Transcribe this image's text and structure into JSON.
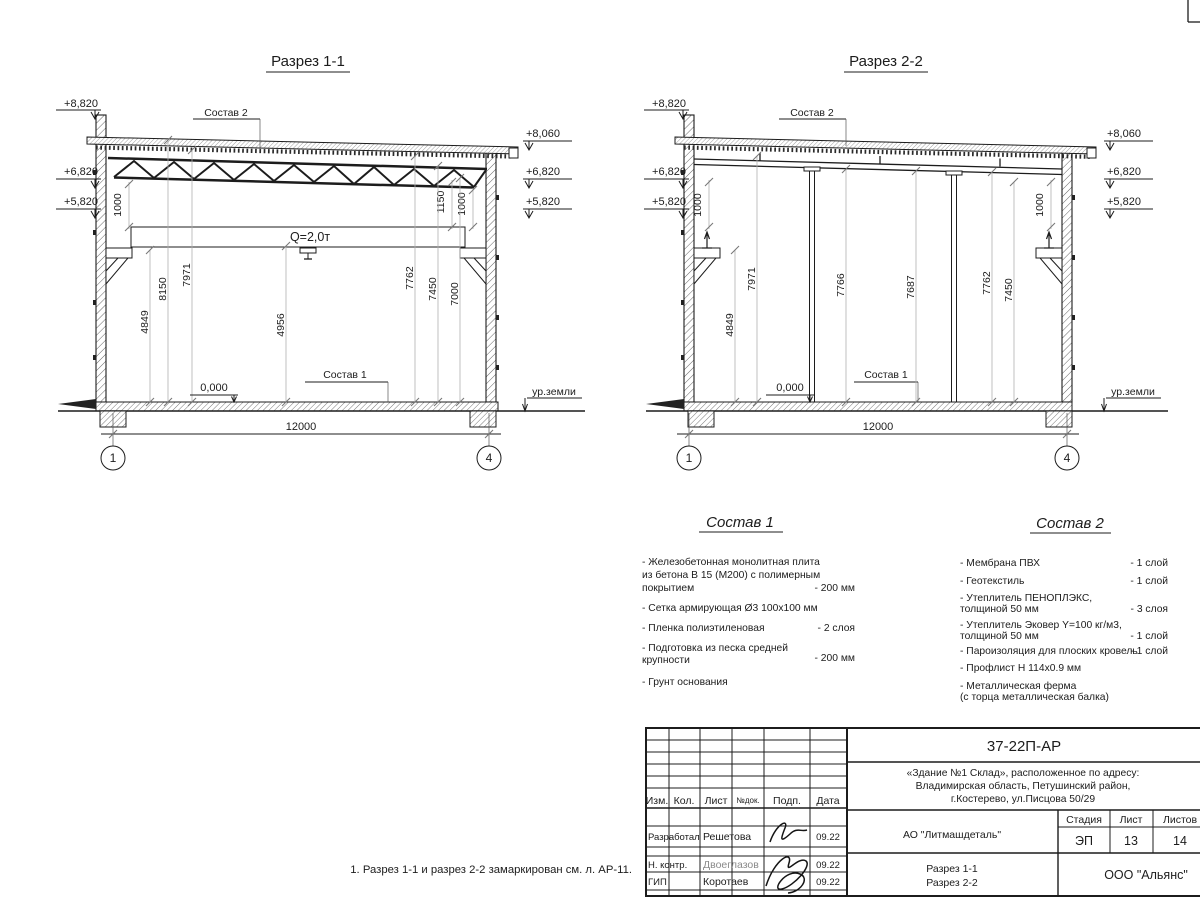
{
  "s1": {
    "title": "Разрез 1-1",
    "sostav2_label": "Состав 2",
    "sostav1_label": "Состав 1",
    "crane_label": "Q=2,0т",
    "elev_left": [
      "+8,820",
      "+6,820",
      "+5,820"
    ],
    "elev_right": [
      "+8,060",
      "+6,820",
      "+5,820"
    ],
    "dim_gap_left": "1000",
    "dim_gap_r1": "1150",
    "dim_gap_r2": "1000",
    "vdims": [
      "4849",
      "8150",
      "7971",
      "4956",
      "7762",
      "7450",
      "7000"
    ],
    "zero_level": "0,000",
    "ground_label": "ур.земли",
    "span": "12000",
    "axis_left": "1",
    "axis_right": "4"
  },
  "s2": {
    "title": "Разрез 2-2",
    "sostav2_label": "Состав 2",
    "sostav1_label": "Состав 1",
    "elev_left": [
      "+8,820",
      "+6,820",
      "+5,820"
    ],
    "elev_right": [
      "+8,060",
      "+6,820",
      "+5,820"
    ],
    "dim_gap_left": "1000",
    "dim_gap_right": "1000",
    "vdims": [
      "4849",
      "7971",
      "7766",
      "7687",
      "7762",
      "7450"
    ],
    "zero_level": "0,000",
    "ground_label": "ур.земли",
    "span": "12000",
    "axis_left": "1",
    "axis_right": "4"
  },
  "sostav1": {
    "title": "Состав 1",
    "items": [
      {
        "lines": [
          "- Железобетонная  монолитная плита",
          "из бетона В 15 (М200) с полимерным",
          "покрытием"
        ],
        "qty": "- 200 мм"
      },
      {
        "lines": [
          "- Сетка армирующая Ø3 100х100 мм"
        ],
        "qty": ""
      },
      {
        "lines": [
          "- Пленка полиэтиленовая"
        ],
        "qty": "-  2 слоя"
      },
      {
        "lines": [
          "- Подготовка из песка средней",
          "  крупности"
        ],
        "qty": "- 200 мм"
      },
      {
        "lines": [
          "- Грунт основания"
        ],
        "qty": ""
      }
    ]
  },
  "sostav2": {
    "title": "Состав 2",
    "items": [
      {
        "lines": [
          "- Мембрана ПВХ"
        ],
        "qty": "- 1 слой"
      },
      {
        "lines": [
          "- Геотекстиль"
        ],
        "qty": "- 1 слой"
      },
      {
        "lines": [
          "- Утеплитель ПЕНОПЛЭКС,",
          "  толщиной 50 мм"
        ],
        "qty": "- 3 слоя"
      },
      {
        "lines": [
          "- Утеплитель Эковер Y=100 кг/м3,",
          "  толщиной 50 мм"
        ],
        "qty": "- 1 слой"
      },
      {
        "lines": [
          "- Пароизоляция для плоских кровель"
        ],
        "qty": "- 1 слой"
      },
      {
        "lines": [
          "- Профлист Н 114х0.9 мм"
        ],
        "qty": ""
      },
      {
        "lines": [
          "- Металлическая ферма",
          "  (с торца металлическая балка)"
        ],
        "qty": ""
      }
    ]
  },
  "note": "1. Разрез 1-1 и разрез 2-2 замаркирован см. л. АР-11.",
  "titleblock": {
    "code": "37-22П-АР",
    "object_lines": [
      "«Здание №1 Склад», расположенное по адресу:",
      "Владимирская область, Петушинский район,",
      "г.Костерево, ул.Писцова 50/29"
    ],
    "columns": [
      "Изм.",
      "Кол.",
      "Лист",
      "№док.",
      "Подп.",
      "Дата"
    ],
    "sign_rows": [
      {
        "role": "Разработал",
        "name": "Решетова",
        "date": "09.22"
      },
      {
        "role": "Н. контр.",
        "name": "Двоеглазов",
        "date": "09.22"
      },
      {
        "role": "ГИП",
        "name": "Коротаев",
        "date": "09.22"
      }
    ],
    "customer": "АО \"Литмашдеталь\"",
    "stage_label": "Стадия",
    "sheet_label": "Лист",
    "sheets_label": "Листов",
    "stage": "ЭП",
    "sheet_no": "13",
    "sheets_total": "14",
    "title_lines": [
      "Разрез 1-1",
      "Разрез 2-2"
    ],
    "org": "ООО \"Альянс\""
  }
}
